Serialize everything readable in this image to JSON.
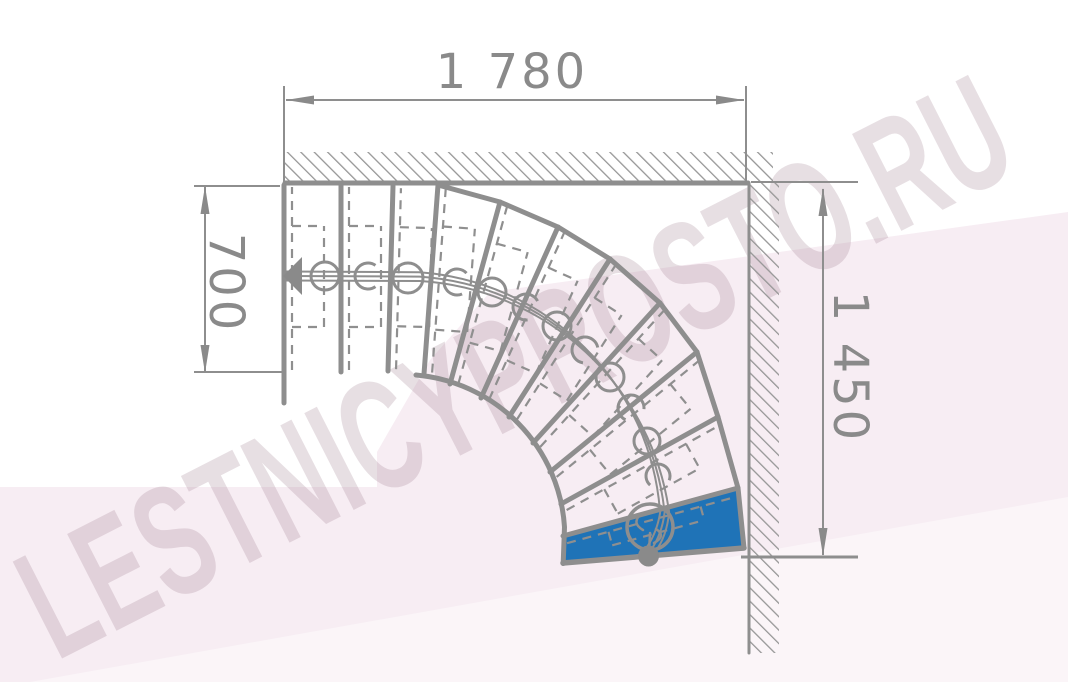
{
  "page": {
    "title": "Quarter-turn winder staircase plan"
  },
  "watermark": {
    "text": "LESTNICYPROSTO.RU",
    "color": "rgba(155,120,140,0.24)",
    "font_size": 158,
    "letter_spacing": 2,
    "transform": "translate(540,415) rotate(-27) scale(0.62,1)"
  },
  "dimensions": {
    "top": {
      "label": "1 780"
    },
    "left": {
      "label": "700"
    },
    "right": {
      "label": "1 450"
    }
  },
  "colors": {
    "line": "#8e8e8e",
    "dash": "#8f8f8f",
    "hatch": "#969696",
    "text": "#8a8a8a",
    "step_highlight": "#1f73b7",
    "pink": "#f7edf3",
    "pink_light_overlay": "rgba(255,255,255,0.45)"
  },
  "drawing": {
    "background_polygons": [
      {
        "name": "pink-wedge",
        "points": "0,487 377,487 377,452 430,360 490,292 1068,212 1068,682 0,682",
        "fill": "#f7edf3"
      },
      {
        "name": "pink-light-wedge",
        "points": "30,682 1068,497 1068,682",
        "fill": "rgba(255,255,255,0.45)"
      }
    ],
    "hatch_rects": [
      {
        "name": "wall-top-hatch",
        "x": 285,
        "y": 152,
        "w": 488,
        "h": 31
      },
      {
        "name": "wall-right-hatch",
        "x": 749,
        "y": 183,
        "w": 30,
        "h": 470
      }
    ],
    "thin_lines": [
      [
        284,
        86,
        284,
        183,
        2
      ],
      [
        286,
        100,
        744,
        100,
        2
      ],
      [
        746,
        86,
        746,
        181,
        2
      ],
      [
        194,
        186,
        280,
        186,
        2
      ],
      [
        194,
        372,
        282,
        372,
        2
      ],
      [
        205,
        187,
        205,
        372,
        2
      ],
      [
        751,
        182,
        858,
        182,
        2
      ],
      [
        741,
        557,
        858,
        557,
        3
      ],
      [
        823,
        189,
        823,
        555,
        2
      ]
    ],
    "thick_lines": [
      [
        285,
        183,
        748,
        183,
        5
      ],
      [
        749,
        184,
        749,
        653,
        3
      ],
      [
        284,
        185,
        284,
        403,
        5
      ],
      [
        563,
        563,
        744,
        548,
        5.5
      ],
      [
        438,
        185,
        500,
        202,
        5
      ],
      [
        500,
        202,
        558,
        227,
        5
      ],
      [
        558,
        227,
        610,
        259,
        5
      ],
      [
        610,
        259,
        660,
        303,
        5
      ],
      [
        660,
        303,
        697,
        352,
        5
      ],
      [
        697,
        352,
        718,
        417,
        5
      ],
      [
        718,
        417,
        738,
        488,
        5
      ],
      [
        738,
        488,
        744,
        548,
        5
      ]
    ],
    "risers": [
      [
        341,
        185,
        341,
        372
      ],
      [
        393,
        186,
        388,
        371
      ],
      [
        438,
        185,
        424,
        374
      ],
      [
        500,
        202,
        450,
        384
      ],
      [
        558,
        227,
        481,
        398
      ],
      [
        610,
        259,
        509,
        417
      ],
      [
        660,
        303,
        533,
        443
      ],
      [
        697,
        352,
        550,
        472
      ],
      [
        718,
        417,
        561,
        504
      ],
      [
        738,
        488,
        563,
        536
      ]
    ],
    "treads": [
      [
        284,
        372,
        284,
        185,
        40
      ],
      [
        341,
        372,
        341,
        185,
        40
      ],
      [
        388,
        371,
        393,
        186,
        40
      ],
      [
        424,
        374,
        438,
        185,
        40
      ],
      [
        450,
        384,
        500,
        202,
        40
      ],
      [
        481,
        398,
        558,
        227,
        40
      ],
      [
        509,
        417,
        610,
        259,
        40
      ],
      [
        533,
        443,
        660,
        303,
        40
      ],
      [
        550,
        472,
        697,
        352,
        40
      ],
      [
        561,
        504,
        718,
        417,
        36
      ],
      [
        563,
        536,
        738,
        488,
        22
      ]
    ],
    "blue_step": {
      "points": "563,536 738,488 744,548 563,563"
    },
    "paths": [
      {
        "d": "M416,375 A163,163 0 0 1 564.5,527 L563.2,563.5",
        "w": 5
      },
      {
        "d": "M286,276 L419.5,276.6 A264,264 0 0 1 664.6,512.4 Q662,534 651,550",
        "w": 2
      },
      {
        "d": "M286,271.5 L419,272.2 A259.5,259.5 0 0 1 660.1,512.9 Q657,532 647,547",
        "w": 2
      },
      {
        "d": "M286,280.5 L420,281 A268.5,268.5 0 0 1 669.1,511.9 Q667,536 655,552",
        "w": 2
      },
      {
        "d": "M641,514 q-10,9 2,16",
        "w": 2.5
      },
      {
        "d": "M656,529 q11,7 -2,14",
        "w": 2.5
      },
      {
        "d": "M650,533 L649,553",
        "w": 2.5
      }
    ],
    "circles": [
      [
        325,
        276,
        14
      ],
      [
        408,
        278,
        15
      ],
      [
        492,
        292,
        14
      ],
      [
        557,
        326,
        14
      ],
      [
        610,
        377,
        14
      ],
      [
        647,
        441,
        13
      ]
    ],
    "hooks": [
      [
        368,
        276,
        13,
        0
      ],
      [
        457,
        282,
        13,
        12
      ],
      [
        526,
        307,
        13,
        28
      ],
      [
        585,
        350,
        13,
        44
      ],
      [
        631,
        408,
        13,
        60
      ],
      [
        658,
        476,
        12,
        76
      ]
    ],
    "big_circle": [
      650,
      527,
      23
    ],
    "dot": [
      648.5,
      556,
      10.5
    ],
    "arrows": [
      {
        "name": "walk-direction-arrow",
        "points": "283,276 302,257 302,295"
      },
      {
        "name": "dim-arrow-top-left",
        "points": "286,100 314,95.5 314,104.5"
      },
      {
        "name": "dim-arrow-top-right",
        "points": "744,100 716,95.5 716,104.5"
      },
      {
        "name": "dim-arrow-left-up",
        "points": "205,186 200.5,214 209.5,214"
      },
      {
        "name": "dim-arrow-left-down",
        "points": "205,373 200.5,345 209.5,345"
      },
      {
        "name": "dim-arrow-right-up",
        "points": "823,188 818.5,216 827.5,216"
      },
      {
        "name": "dim-arrow-right-down",
        "points": "823,556 818.5,528 827.5,528"
      }
    ]
  }
}
